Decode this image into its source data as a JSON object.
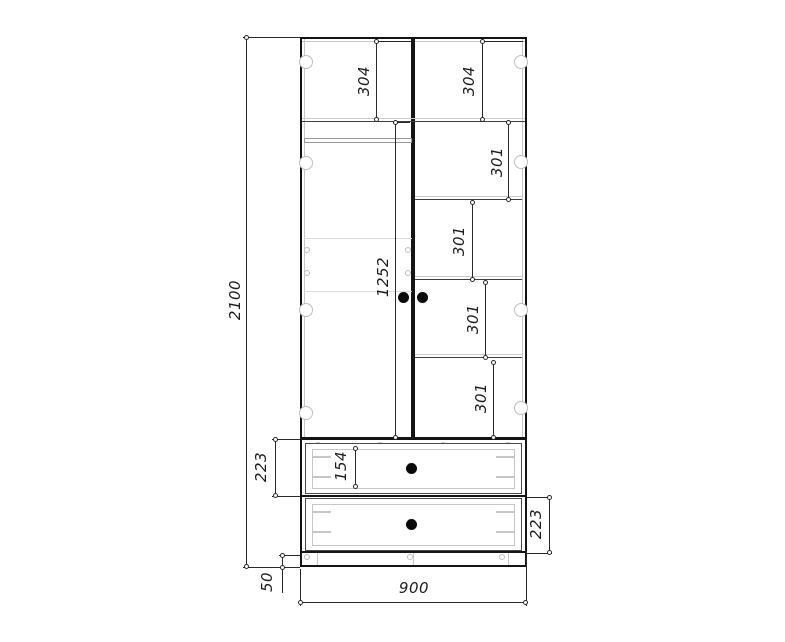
{
  "drawing": {
    "type": "furniture-front-elevation",
    "subject": "two-door wardrobe with shelves and two drawers",
    "colors": {
      "background": "#ffffff",
      "heavy_line": "#141414",
      "dim_line": "#2a2a2a",
      "light_line": "#c6c6c6"
    },
    "dimensions": {
      "overall_height": "2100",
      "overall_width": "900",
      "plinth_height": "50",
      "door_section_height": "1252",
      "top_compartment_left": "304",
      "top_compartment_right": "304",
      "right_shelf_gap_1": "301",
      "right_shelf_gap_2": "301",
      "right_shelf_gap_3": "301",
      "right_shelf_gap_4": "301",
      "drawer_top_height": "223",
      "drawer_bottom_height": "223",
      "drawer_inner_front_height": "154"
    }
  }
}
